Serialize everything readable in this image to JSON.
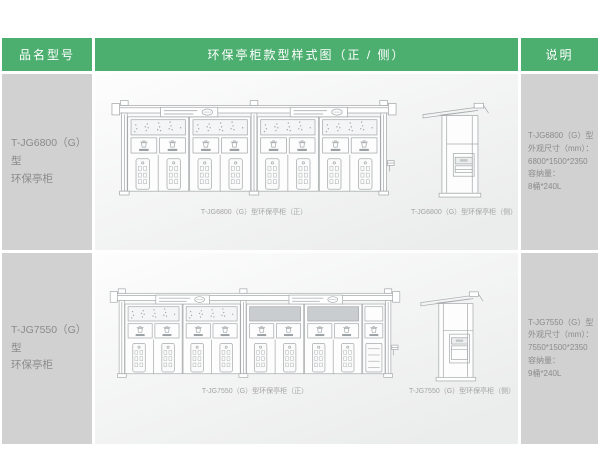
{
  "header": {
    "col_product": "品名型号",
    "col_diagram": "环保亭柜款型样式图（正 / 侧）",
    "col_notes": "说明"
  },
  "rows": [
    {
      "model_line1": "T-JG6800（G）型",
      "model_line2": "环保亭柜",
      "front_caption": "T-JG6800（G）型环保亭柜（正）",
      "side_caption": "T-JG6800（G）型环保亭柜（侧）",
      "specs": [
        "T-JG6800（G）型",
        "外观尺寸（mm）：",
        "6800*1500*2350",
        "容纳量：",
        "8桶*240L"
      ]
    },
    {
      "model_line1": "T-JG7550（G）型",
      "model_line2": "环保亭柜",
      "front_caption": "T-JG7550（G）型环保亭柜（正）",
      "side_caption": "T-JG7550（G）型环保亭柜（侧）",
      "specs": [
        "T-JG7550（G）型",
        "外观尺寸（mm）：",
        "7550*1500*2350",
        "容纳量：",
        "9桶*240L"
      ]
    }
  ],
  "drawings": {
    "row1_front": {
      "modules": [
        {
          "bays": 2,
          "top": "dots"
        },
        {
          "bays": 2,
          "top": "dots"
        }
      ],
      "end_bay": false
    },
    "row2_front": {
      "modules": [
        {
          "bays": 2,
          "top": "dots"
        },
        {
          "bays": 2,
          "top": "shaded",
          "end": true
        }
      ],
      "end_bay": true
    },
    "row1_side": {
      "hatch_y": 66,
      "hatch_h": 24
    },
    "row2_side": {
      "hatch_y": 60,
      "hatch_h": 32
    }
  },
  "colors": {
    "header_bg": "#4caf70",
    "header_text": "#ffffff",
    "cell_bg": "#d1d1d1",
    "cell_text": "#8b8b8b",
    "line": "#a7abad",
    "caption": "#a3a3a3"
  }
}
